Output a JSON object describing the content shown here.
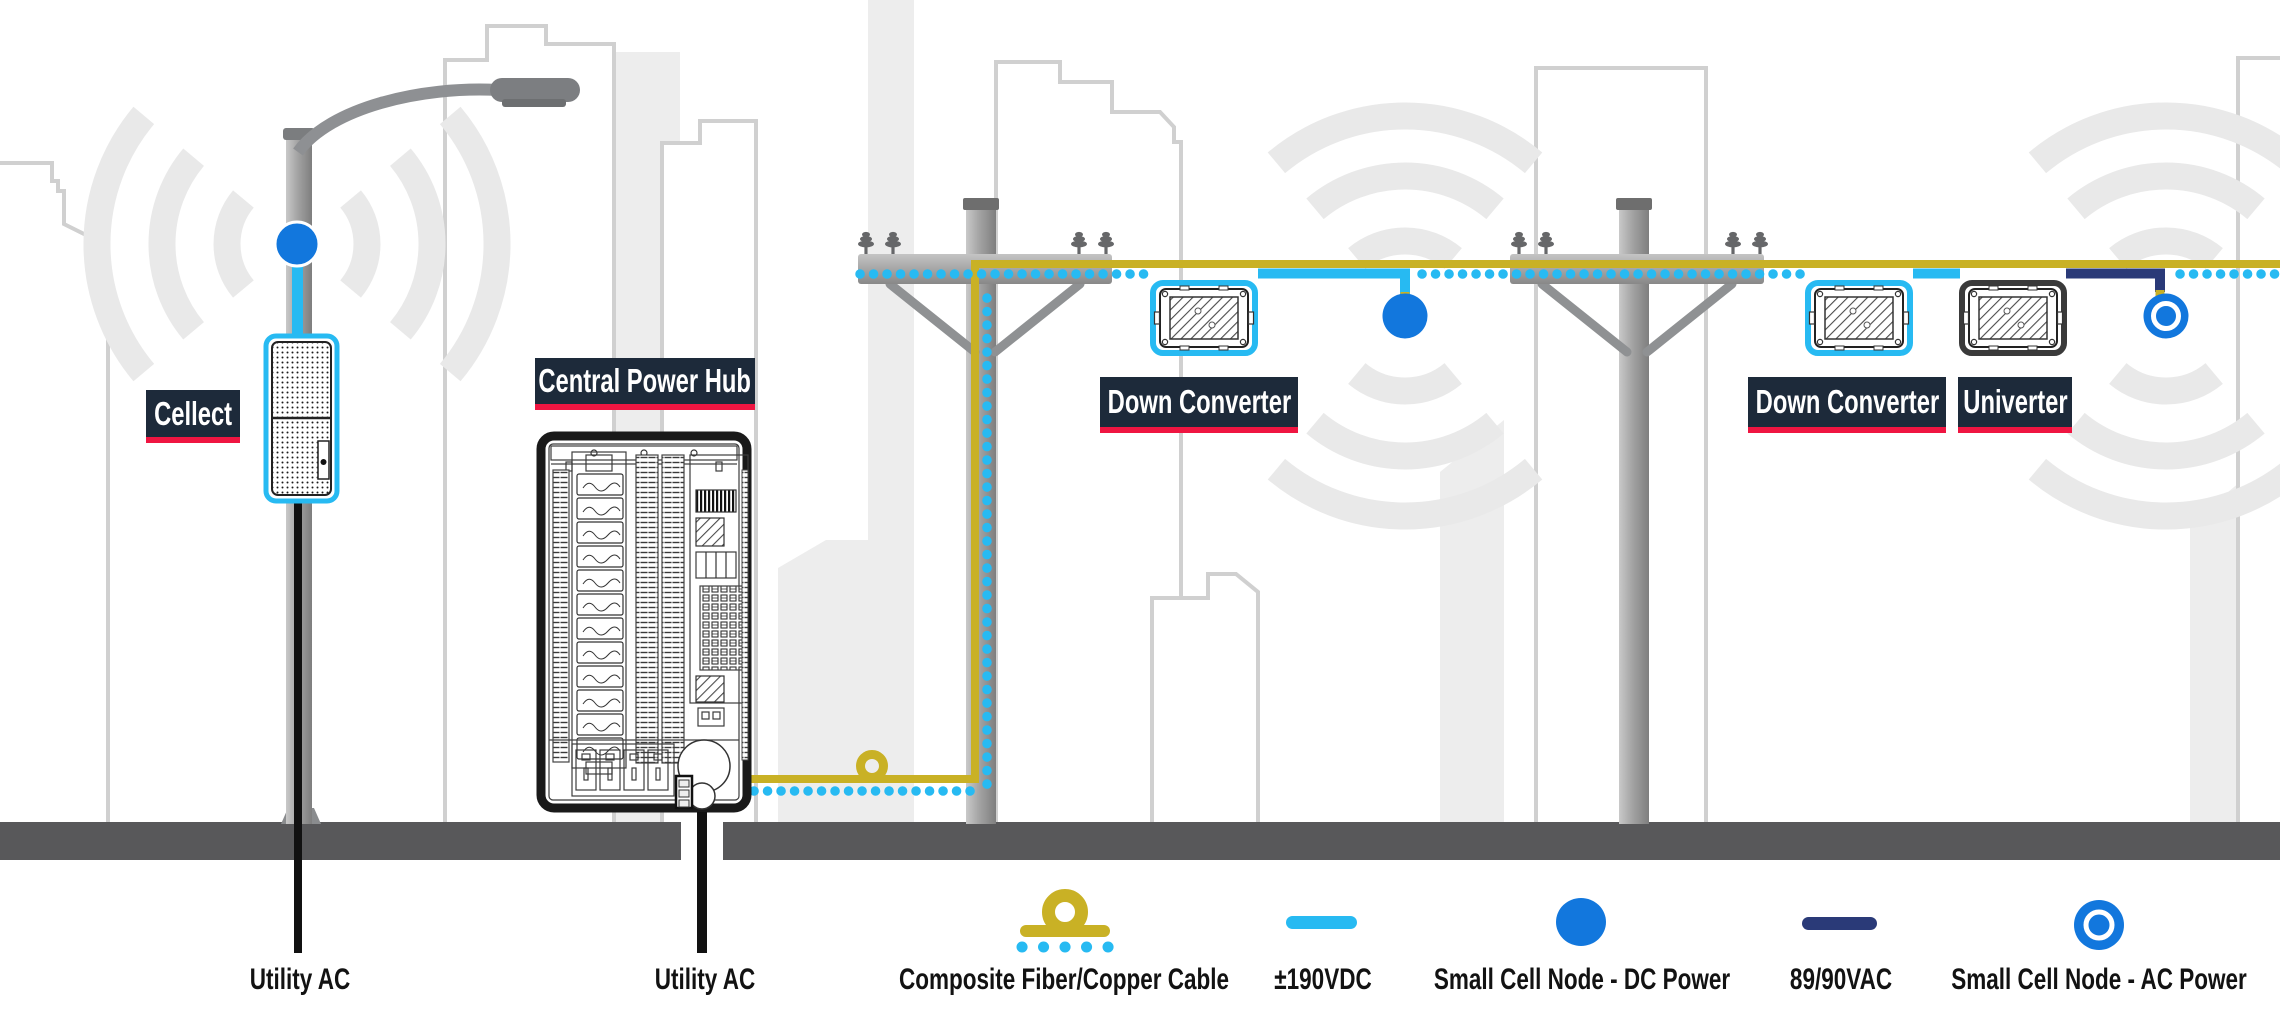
{
  "labels": {
    "cellect": "Cellect",
    "central_power_hub": "Central Power Hub",
    "down_converter_1": "Down Converter",
    "down_converter_2": "Down Converter",
    "univerter": "Univerter"
  },
  "legend": {
    "utility_ac_1": "Utility AC",
    "utility_ac_2": "Utility AC",
    "composite_cable": "Composite Fiber/Copper Cable",
    "dc_190": "±190VDC",
    "dc_node": "Small Cell Node - DC Power",
    "ac_8990": "89/90VAC",
    "ac_node": "Small Cell Node - AC Power"
  },
  "icons": {
    "composite_cable": "yellow-cable-with-slack-loop-and-blue-dots",
    "dc_190": "cyan-line",
    "dc_node": "solid-blue-circle",
    "ac_8990": "navy-line",
    "ac_node": "blue-circle-with-white-ring",
    "utility_ac": "black-cable"
  },
  "colors": {
    "label_bg": "#1d2a3a",
    "label_underline": "#ef1541",
    "composite_yellow": "#c9b125",
    "dc_cyan": "#27baf2",
    "node_blue": "#1277dd",
    "ac_navy": "#2a3a78",
    "ground_gray": "#58585a"
  }
}
